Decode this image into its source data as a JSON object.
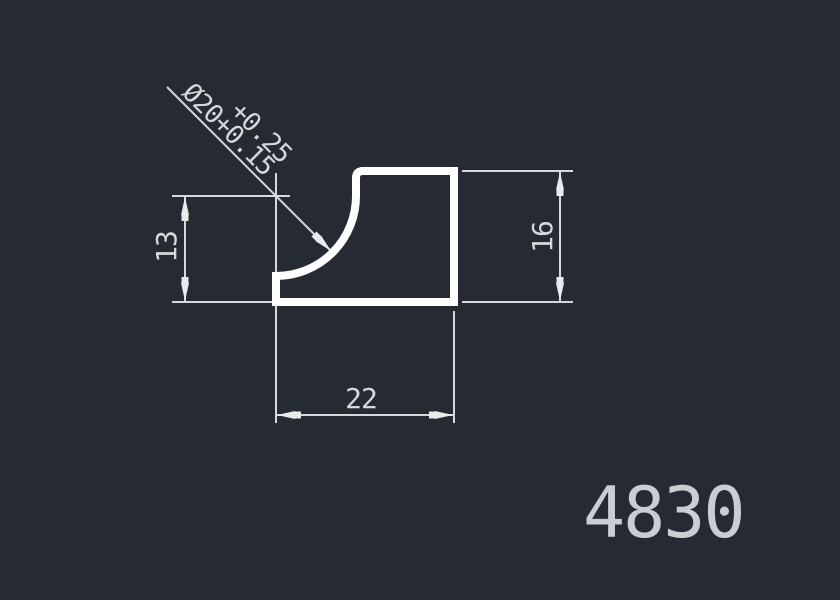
{
  "canvas": {
    "background_color": "#262a33",
    "line_color": "#d6d8da",
    "profile_color": "#ffffff"
  },
  "dimensions": {
    "left_height": {
      "value": "13"
    },
    "overall_height": {
      "value": "16"
    },
    "overall_width": {
      "value": "22"
    },
    "arc_callout": {
      "diameter": "Ø20",
      "tolerance_upper": "+0.25",
      "tolerance_lower": "+0.15"
    }
  },
  "part_number": "4830"
}
